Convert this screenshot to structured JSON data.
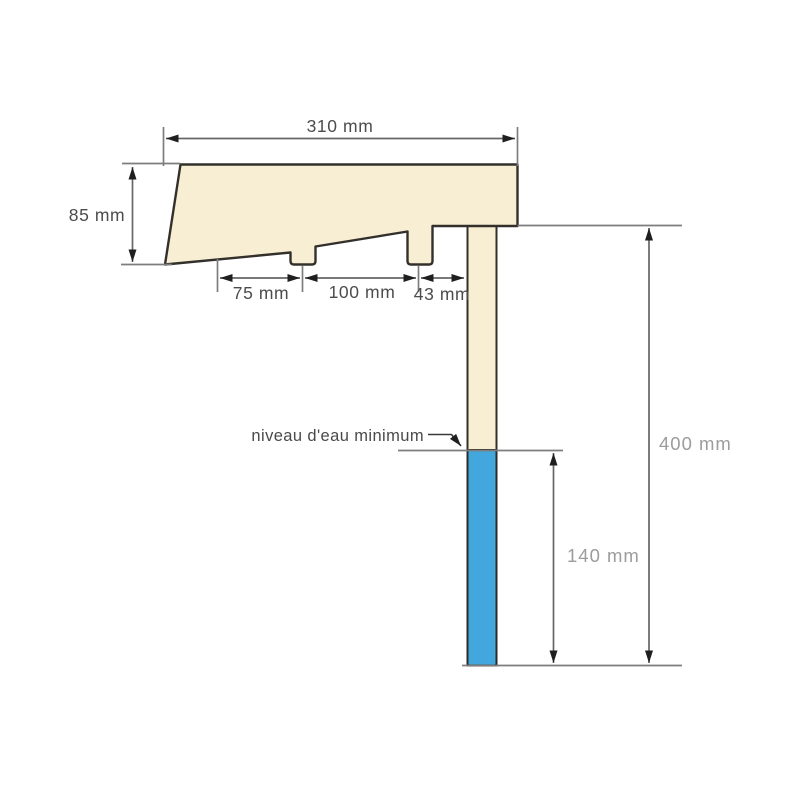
{
  "diagram": {
    "labels": {
      "top_width": "310 mm",
      "left_height": "85 mm",
      "under_left": "75 mm",
      "under_mid": "100 mm",
      "under_right": "43 mm",
      "total_height": "400 mm",
      "water_depth": "140 mm"
    },
    "annotations": {
      "water_level": "niveau d'eau minimum"
    },
    "colors": {
      "background": "#ffffff",
      "coping_fill": "#f7eed3",
      "wall_fill": "#f7eed3",
      "water_fill": "#42a7dd",
      "outline": "#33302b",
      "dimension_line": "#666666",
      "extension_line": "#7d7d7d",
      "arrowhead": "#1f1f1f",
      "label_dark": "#4c4c4c",
      "label_light": "#9c9c9c"
    }
  }
}
